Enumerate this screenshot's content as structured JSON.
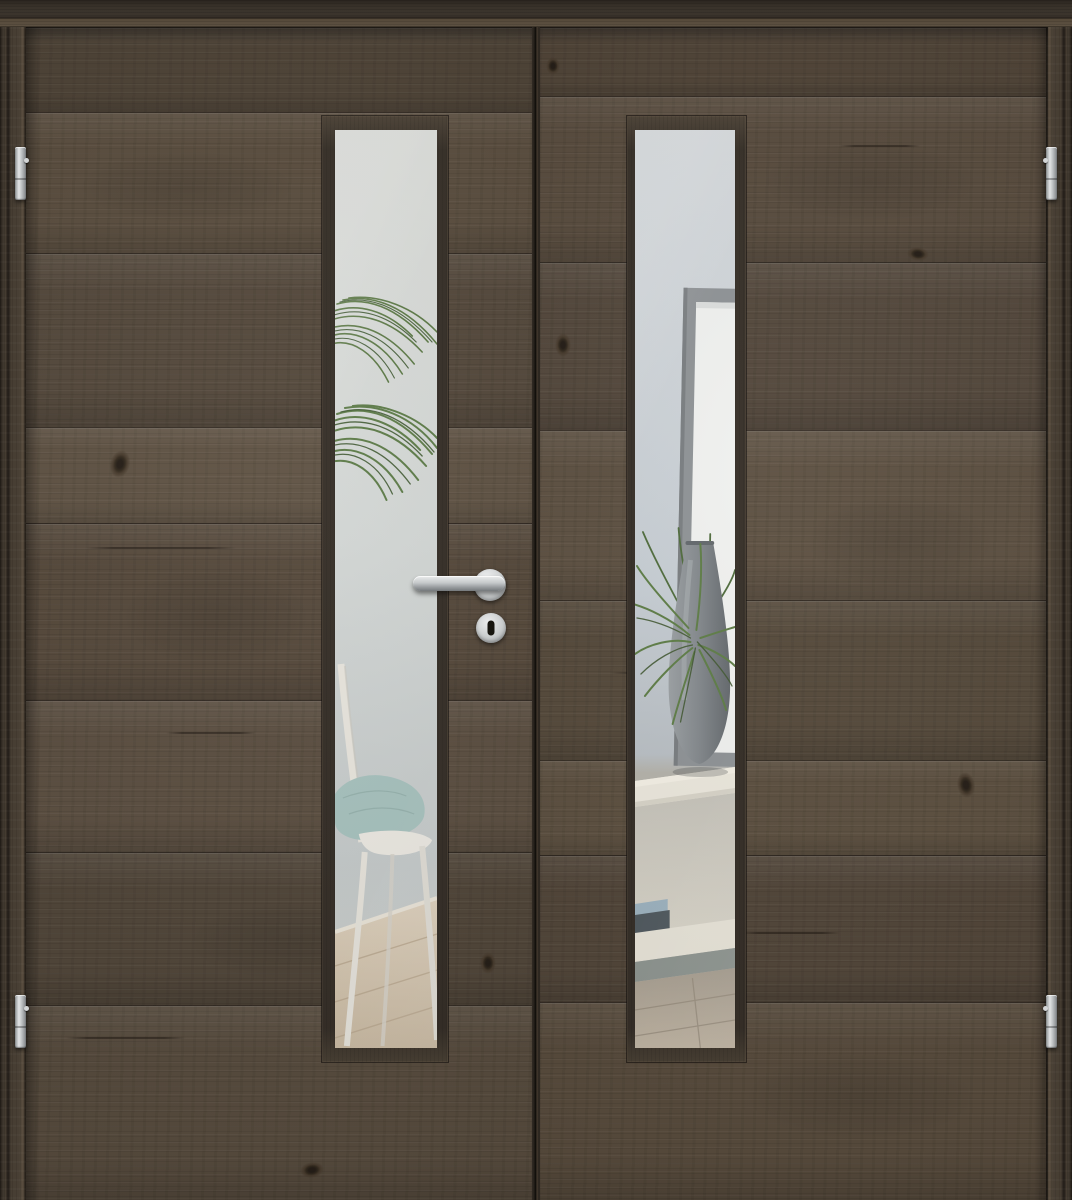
{
  "image": {
    "kind": "product photo render",
    "subject": "Double interior door in dark rustic oak with narrow vertical glazing and stainless steel hardware",
    "room_view": "bright interior room visible through the glass lites"
  },
  "door": {
    "leaves": 2,
    "finish": "dark old-oak laminate, horizontal plank grain with knots and cracks",
    "frame": "matching dark oak frame on top, left and right",
    "center_seam": "vertical meeting stile between the two leaves",
    "glazing_shape": "narrow full-height vertical lite offset toward the center of each leaf"
  },
  "hardware": {
    "lever_handle": "straight stainless steel lever on round rose, left leaf",
    "escutcheon": "round stainless escutcheon with dark keyhole below the handle",
    "hinges": [
      {
        "position": "upper left"
      },
      {
        "position": "lower left"
      },
      {
        "position": "upper right"
      },
      {
        "position": "lower right"
      }
    ],
    "hinge_finish": "satin chrome"
  },
  "glass_scene_left": {
    "contents": [
      "light grey wall",
      "arching palm fronds",
      "white wooden chair",
      "mint-green cushion",
      "light wood plank floor",
      "white skirting board"
    ]
  },
  "glass_scene_right": {
    "contents": [
      "light grey-blue wall",
      "leaning picture frame with white mat",
      "grey drop-shaped vase",
      "green grass plant",
      "white sideboard with open shelf",
      "two stacked books",
      "light wood floor in shadow"
    ]
  },
  "palette": {
    "wood_dark": "#362f27",
    "wood_mid": "#55483a",
    "wood_light": "#6b5c4a",
    "glass_wall_left": "#d7dad7",
    "glass_wall_right": "#c9d0d5",
    "plant_green": "#5d7c45",
    "plant_green_dark": "#415831",
    "vase_grey": "#82878b",
    "shelf_white": "#ece8dd",
    "floor_wood": "#d6c8b4",
    "cushion_mint": "#a6c1bd",
    "chrome": "#c6c8ca"
  }
}
